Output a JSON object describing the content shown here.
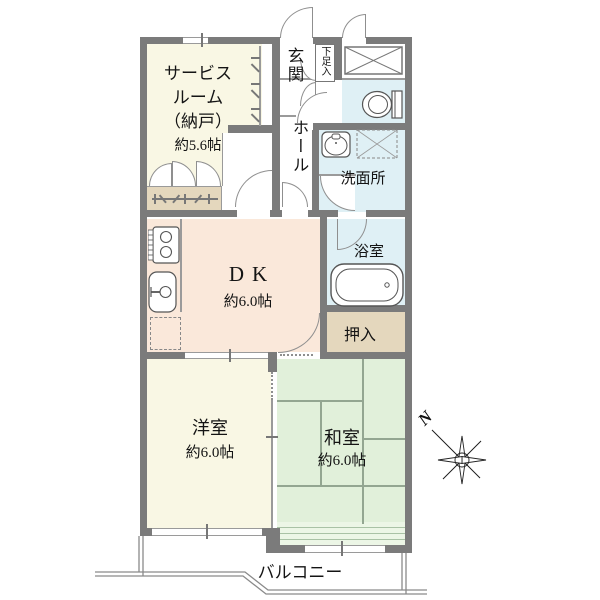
{
  "rooms": {
    "service_room": {
      "name_lines": [
        "サービス",
        "ルーム",
        "（納戸）"
      ],
      "size": "約5.6帖"
    },
    "entrance": {
      "name": "玄関"
    },
    "shoe_cabinet": {
      "name": "下足入"
    },
    "hall": {
      "name": "ホール"
    },
    "washroom": {
      "name": "洗面所"
    },
    "dining_kitchen": {
      "name": "DK",
      "size": "約6.0帖"
    },
    "bathroom": {
      "name": "浴室"
    },
    "closet": {
      "name": "押入"
    },
    "western_room": {
      "name": "洋室",
      "size": "約6.0帖"
    },
    "japanese_room": {
      "name": "和室",
      "size": "約6.0帖"
    },
    "balcony": {
      "name": "バルコニー"
    }
  },
  "compass": {
    "north": "N"
  },
  "icons": [
    "stove-icon",
    "kitchen-sink-icon",
    "refrigerator-space",
    "washbasin-icon",
    "washing-machine-space",
    "toilet-icon",
    "bathtub-icon",
    "trunk-closet-cross",
    "closet-hanger-symbol",
    "compass-rose"
  ],
  "colors": {
    "wall": "#7b7b7b",
    "service_room": "#f9f7e4",
    "western_room": "#f9f7e4",
    "dining_kitchen": "#fae8da",
    "wet_area": "#dff0f5",
    "closet": "#e4d7bd",
    "tatami": "#e1f0da",
    "tatami_sill": "#ecf6e6"
  }
}
